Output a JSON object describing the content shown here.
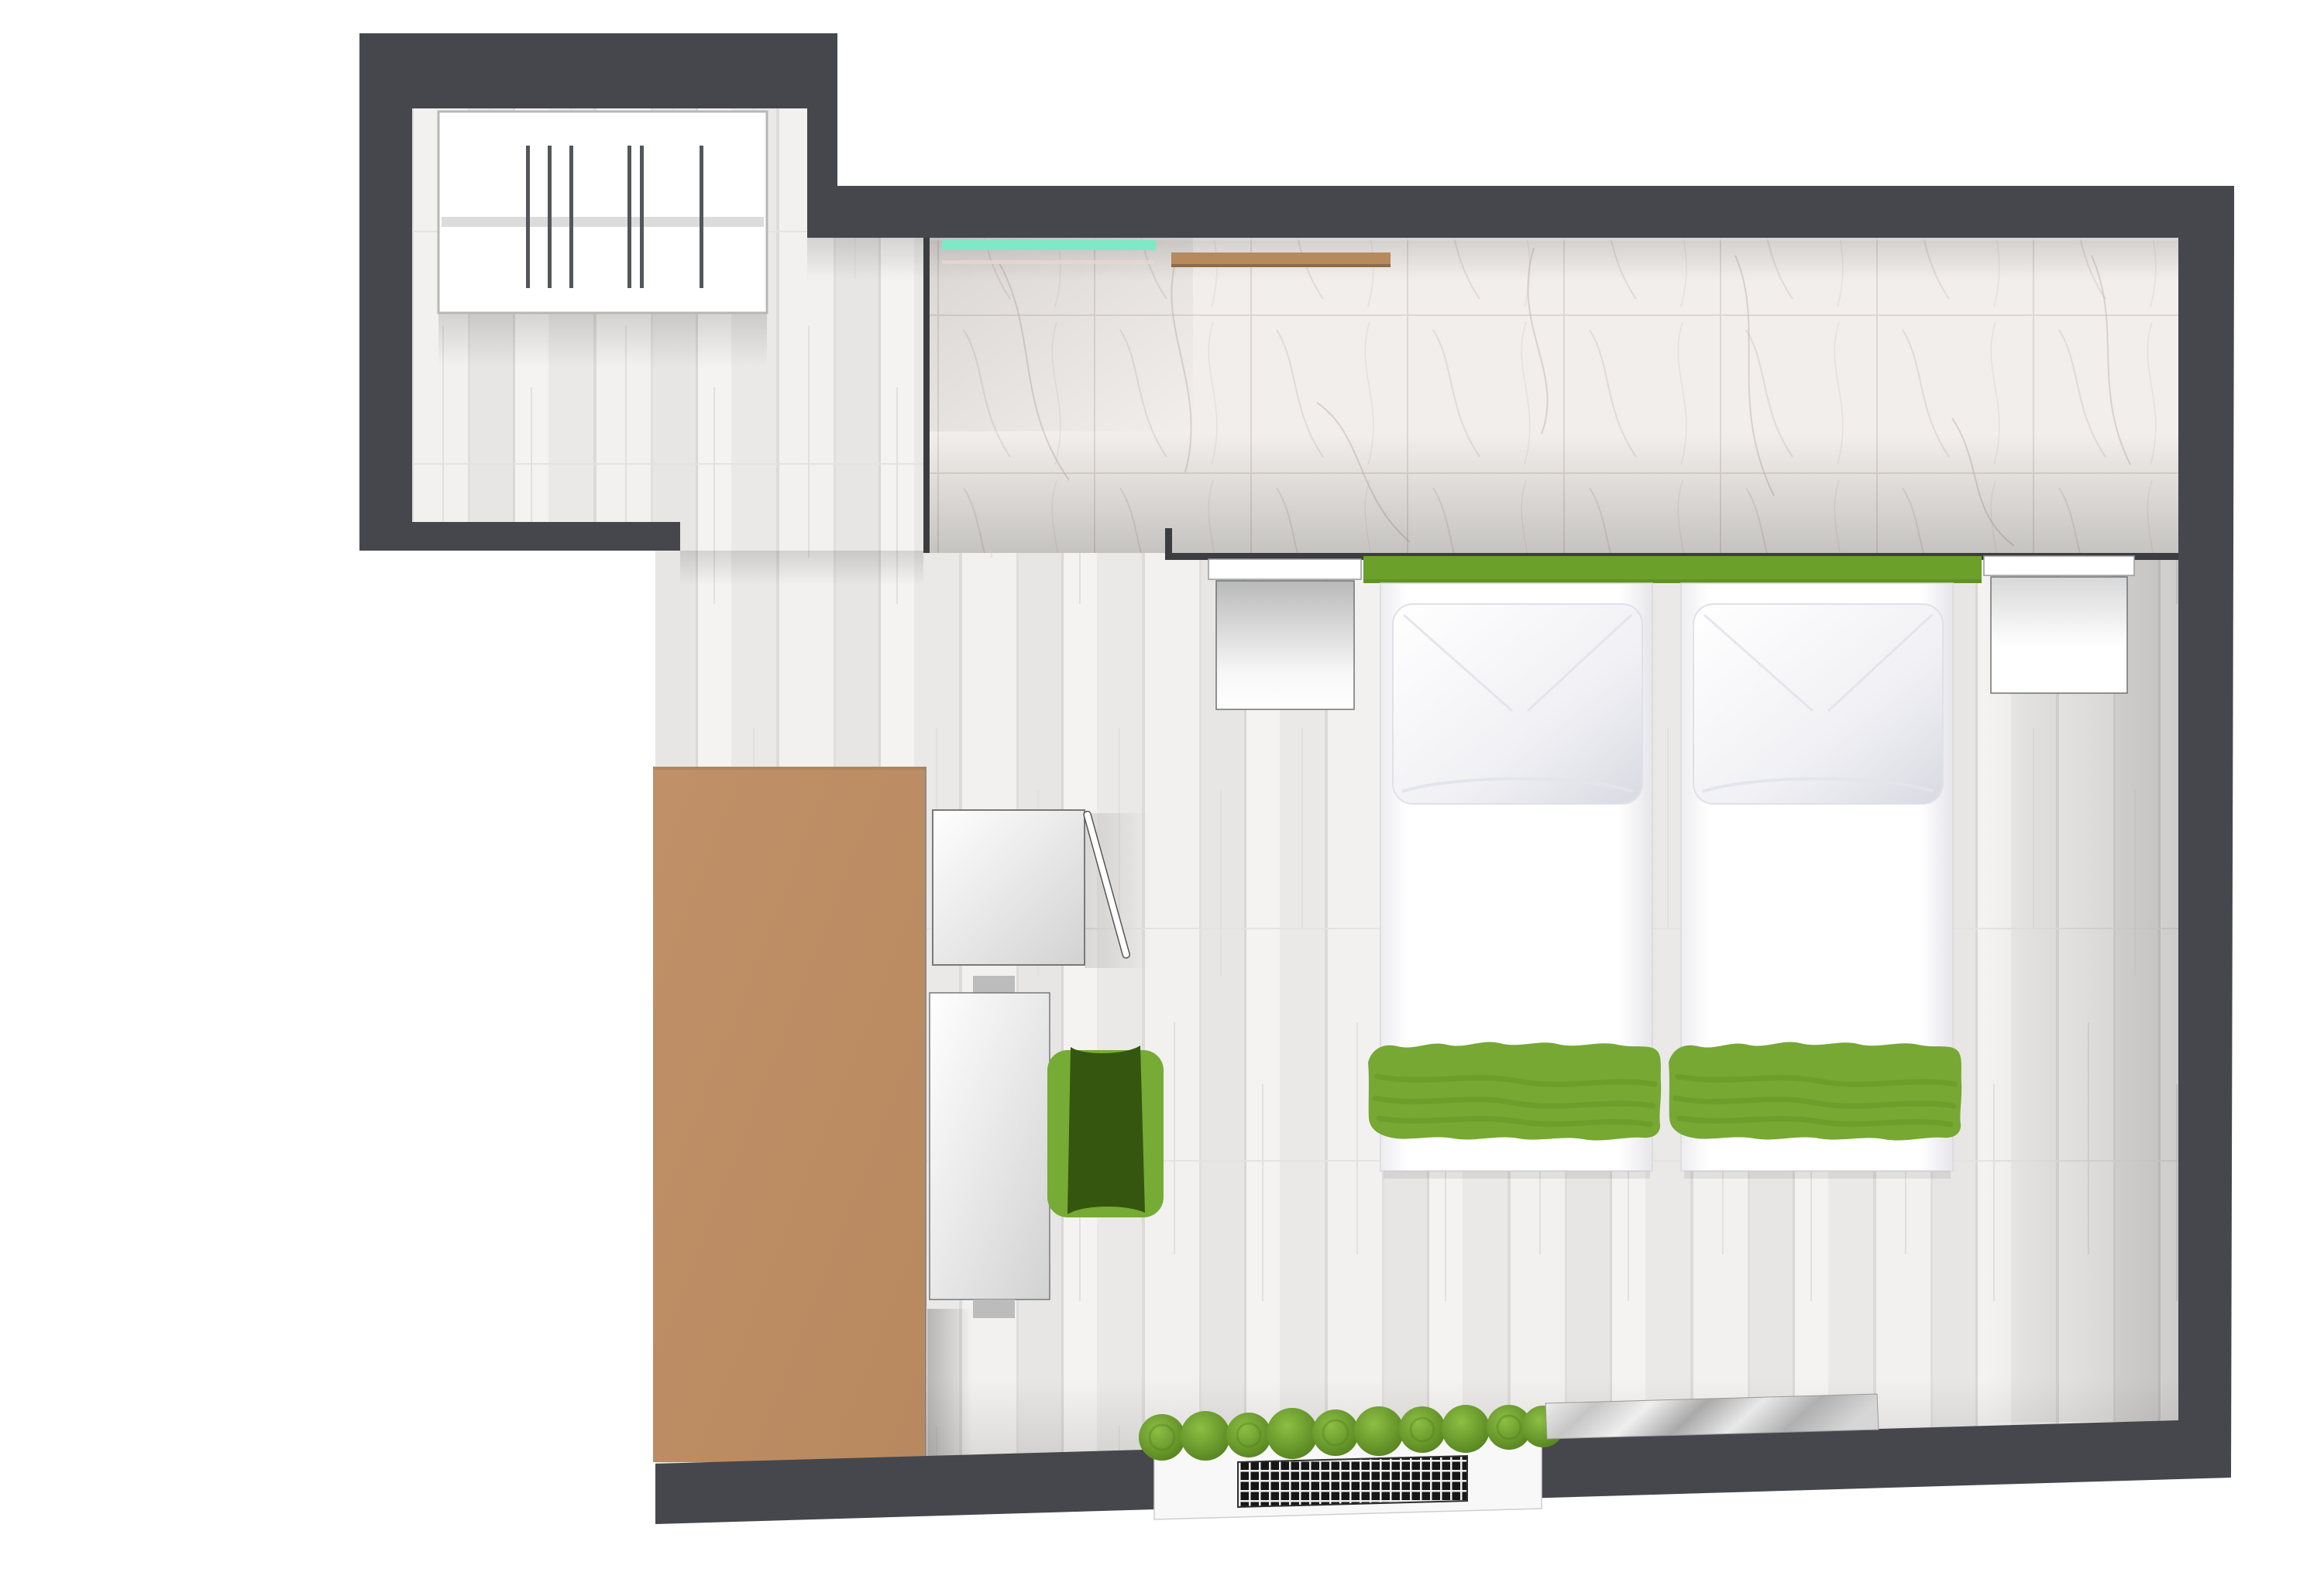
{
  "diagram": {
    "type": "floor-plan",
    "subject": "top-down rendered floor plan of a twin-bed hotel room",
    "rooms": [
      {
        "name": "wardrobe-alcove",
        "floor": "light wood planks"
      },
      {
        "name": "entry-bath-strip",
        "floor": "white marble tile"
      },
      {
        "name": "bedroom",
        "floor": "light wood planks"
      }
    ],
    "furniture": [
      {
        "name": "wardrobe",
        "detail": "open wardrobe with rail and 6 hangers"
      },
      {
        "name": "glass-shelf",
        "detail": "teal glass strip on tile wall"
      },
      {
        "name": "wall-shelf",
        "detail": "wooden shelf strip on tile wall"
      },
      {
        "name": "headboard-panel",
        "detail": "green headboard board behind both beds"
      },
      {
        "name": "nightstand-left",
        "detail": "white nightstand"
      },
      {
        "name": "nightstand-right",
        "detail": "white nightstand"
      },
      {
        "name": "twin-bed-left",
        "detail": "white mattress, white pillow, green runner at foot"
      },
      {
        "name": "twin-bed-right",
        "detail": "white mattress, white pillow, green runner at foot"
      },
      {
        "name": "desk",
        "detail": "long wooden desk / counter along left side"
      },
      {
        "name": "minibar-cabinet",
        "detail": "cabinet with door drawn open"
      },
      {
        "name": "tall-cabinet",
        "detail": "white cabinet"
      },
      {
        "name": "desk-chair",
        "detail": "green chair"
      },
      {
        "name": "radiator",
        "detail": "radiator with black grill in bottom wall"
      },
      {
        "name": "plant-row",
        "detail": "row of 10 round green plants",
        "count": 10
      },
      {
        "name": "entry-mat",
        "detail": "silver metallic mat on bottom wall"
      }
    ],
    "hanger_count": 6
  },
  "colors": {
    "background": "#ffffff",
    "wall": "#45474c",
    "wall_thin": "#3b3d41",
    "wood_base": "#efeeec",
    "wood_shade": "#e7e6e4",
    "tile_base": "#f1eeeb",
    "tile_joint": "#ded7d1",
    "marble_vein": "#c2b4ac",
    "wardrobe_fill": "#ffffff",
    "wardrobe_border": "#b7b7b7",
    "hanger_rail": "#dcdcdc",
    "hanger": "#53565a",
    "glass_shelf": "#7ee8c7",
    "glass_shelf_accent": "#ecd4d2",
    "wall_shelf": "#b68a5c",
    "wall_shelf_edge": "#8f6a45",
    "headboard": "#6ba02b",
    "mattress_edge": "#d8d8dd",
    "pillow_shade": "#d9dae2",
    "blanket": "#77a833",
    "blanket_fold": "#5f8f21",
    "nightstand_border": "#6f7276",
    "desk": "#c09068",
    "desk_edge": "#a87d55",
    "cabinet_border": "#77797c",
    "chair_seat": "#35560f",
    "chair_frame": "#76ab35",
    "radiator_body": "#f8f8f8",
    "radiator_grill": "#161616",
    "plant_light": "#8cbf43",
    "plant_dark": "#527f1d",
    "plant_ring": "#4c7a1a",
    "mat_light": "#f4f4f4",
    "mat_dark": "#a9a9a9"
  }
}
